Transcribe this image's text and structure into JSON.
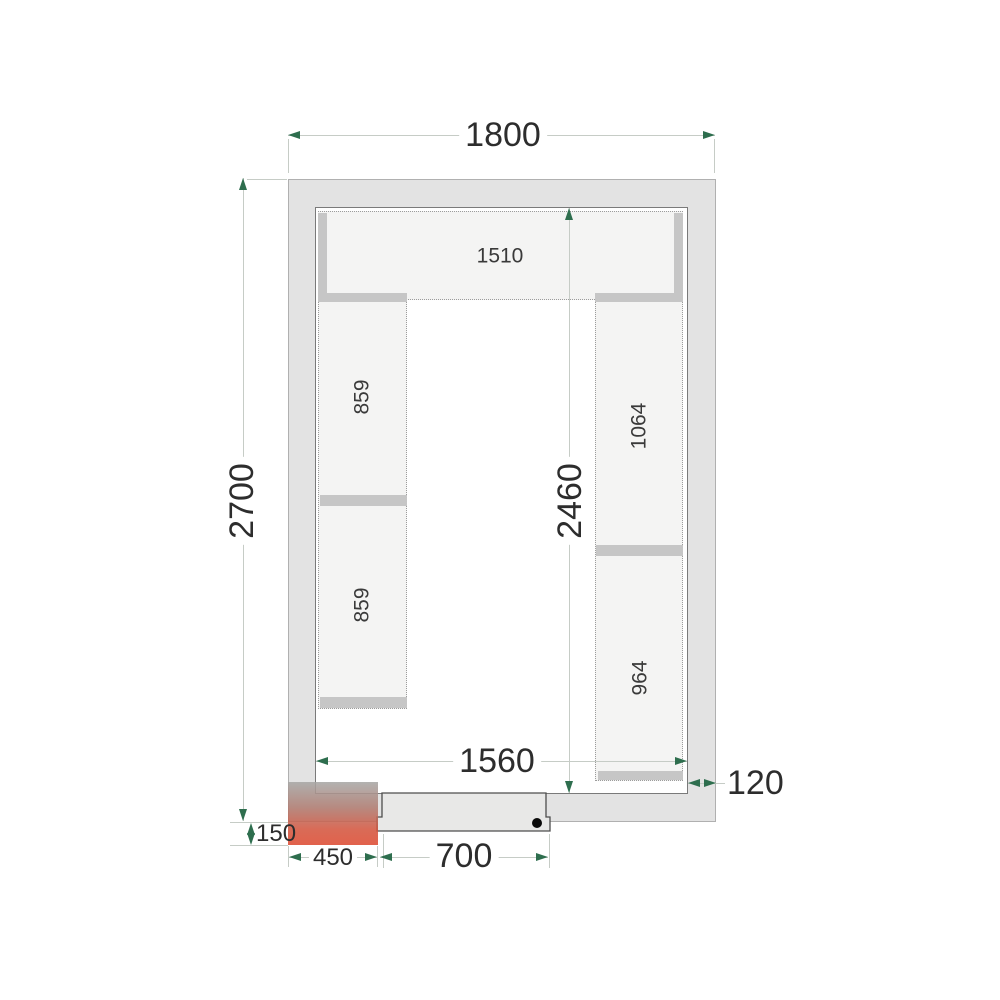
{
  "title": "Cold room floor plan technical drawing",
  "dimensions": {
    "outer_width": "1800",
    "outer_depth": "2700",
    "inner_width": "1560",
    "inner_depth": "2460",
    "wall_thickness": "120",
    "unit_offset": "150",
    "unit_width": "450",
    "door_width": "700"
  },
  "shelves": {
    "top": "1510",
    "left_upper": "859",
    "left_lower": "859",
    "right_upper": "1064",
    "right_lower": "964"
  },
  "colors": {
    "wall_fill": "#e3e3e3",
    "shelf_fill": "#f4f4f3",
    "band_gray": "#c6c6c6",
    "dim_line": "#c6ccc6",
    "arrow_green": "#2e6e4e",
    "unit_red": "#dd4a31",
    "door_fill": "#e8e8e7"
  }
}
